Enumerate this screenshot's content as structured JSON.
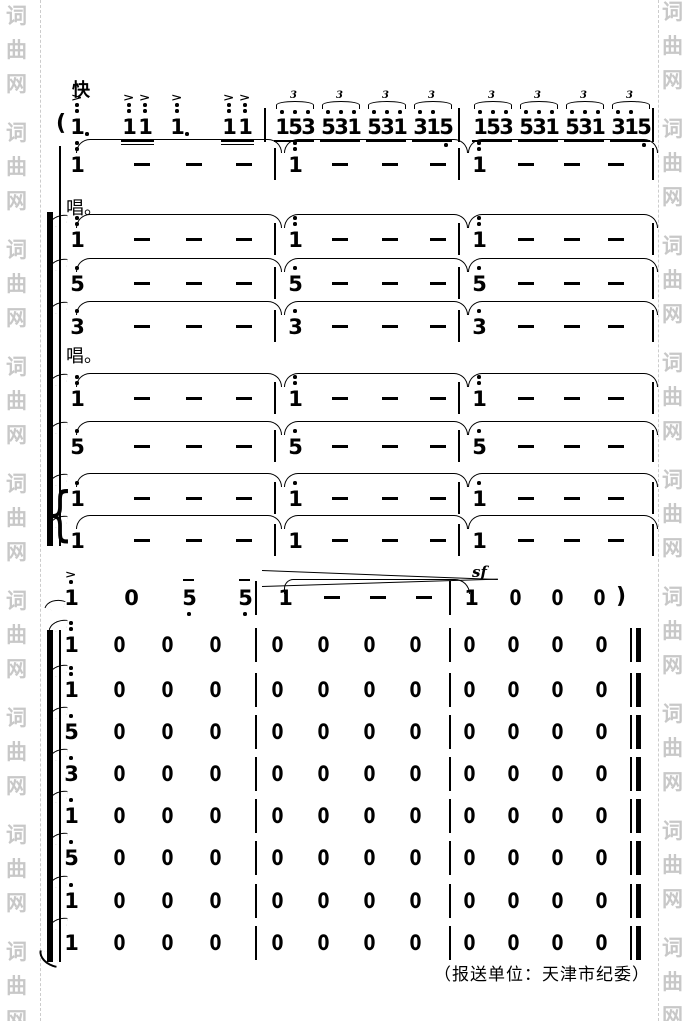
{
  "header": {
    "tempo": "快"
  },
  "labels": {
    "chang1": "唱。",
    "chang2": "唱。"
  },
  "credit": "（报送单位：天津市纪委）",
  "watermark": {
    "text": "词曲网",
    "color": "#c8c8c8",
    "repeats_per_side": 9
  },
  "lead_line": {
    "open_paren": "(",
    "tuplet_number": "3",
    "measure1": [
      {
        "type": "note",
        "digit": "1",
        "octave_dots": 2,
        "accent": true,
        "dotted": true
      },
      {
        "type": "pair",
        "digits": [
          "1",
          "1"
        ],
        "octave_dots": 2,
        "accent": true,
        "underlines": 2
      },
      {
        "type": "note",
        "digit": "1",
        "octave_dots": 2,
        "accent": true,
        "dotted": true
      },
      {
        "type": "pair",
        "digits": [
          "1",
          "1"
        ],
        "octave_dots": 2,
        "accent": true,
        "underlines": 2
      }
    ],
    "measure2_triplets": [
      [
        "1",
        "5",
        "3"
      ],
      [
        "5",
        "3",
        "1"
      ],
      [
        "5",
        "3",
        "1"
      ],
      [
        "3",
        "1",
        "5"
      ]
    ],
    "measure3_triplets": [
      [
        "1",
        "5",
        "3"
      ],
      [
        "5",
        "3",
        "1"
      ],
      [
        "5",
        "3",
        "1"
      ],
      [
        "3",
        "1",
        "5"
      ]
    ]
  },
  "held_rows": [
    {
      "start_digit": "1",
      "octave_dots": 2,
      "dashes": [
        "-",
        "-",
        "-"
      ]
    },
    {
      "start_digit": "1",
      "octave_dots": 2,
      "dashes": [
        "-",
        "-",
        "-"
      ]
    },
    {
      "start_digit": "5",
      "octave_dots": 1,
      "dashes": [
        "-",
        "-",
        "-"
      ]
    },
    {
      "start_digit": "3",
      "octave_dots": 1,
      "dashes": [
        "-",
        "-",
        "-"
      ]
    },
    {
      "start_digit": "1",
      "octave_dots": 2,
      "dashes": [
        "-",
        "-",
        "-"
      ]
    },
    {
      "start_digit": "5",
      "octave_dots": 1,
      "dashes": [
        "-",
        "-",
        "-"
      ]
    },
    {
      "start_digit": "1",
      "octave_dots": 1,
      "dashes": [
        "-",
        "-",
        "-"
      ]
    },
    {
      "start_digit": "1",
      "octave_dots": 0,
      "dashes": [
        "-",
        "-",
        "-"
      ]
    }
  ],
  "interlude_row": {
    "measure1": [
      {
        "digit": "1",
        "accent": true,
        "octave_dots": 1
      },
      {
        "digit": "0"
      },
      {
        "digit": "5",
        "tenuto": true,
        "low_dots": 1
      },
      {
        "digit": "5",
        "tenuto": true,
        "low_dots": 1
      }
    ],
    "measure2": [
      "1",
      "-",
      "-",
      "-"
    ],
    "measure3": [
      "1",
      "0",
      "0",
      "0"
    ],
    "sforzando": "sf",
    "close_paren": ")"
  },
  "rest_rows": [
    {
      "start_digit": "1",
      "octave_dots": 2,
      "rests_m1": [
        "0",
        "0",
        "0"
      ],
      "rests_m2": [
        "0",
        "0",
        "0",
        "0"
      ],
      "rests_m3": [
        "0",
        "0",
        "0",
        "0"
      ]
    },
    {
      "start_digit": "1",
      "octave_dots": 2,
      "rests_m1": [
        "0",
        "0",
        "0"
      ],
      "rests_m2": [
        "0",
        "0",
        "0",
        "0"
      ],
      "rests_m3": [
        "0",
        "0",
        "0",
        "0"
      ]
    },
    {
      "start_digit": "5",
      "octave_dots": 1,
      "rests_m1": [
        "0",
        "0",
        "0"
      ],
      "rests_m2": [
        "0",
        "0",
        "0",
        "0"
      ],
      "rests_m3": [
        "0",
        "0",
        "0",
        "0"
      ]
    },
    {
      "start_digit": "3",
      "octave_dots": 1,
      "rests_m1": [
        "0",
        "0",
        "0"
      ],
      "rests_m2": [
        "0",
        "0",
        "0",
        "0"
      ],
      "rests_m3": [
        "0",
        "0",
        "0",
        "0"
      ]
    },
    {
      "start_digit": "1",
      "octave_dots": 1,
      "rests_m1": [
        "0",
        "0",
        "0"
      ],
      "rests_m2": [
        "0",
        "0",
        "0",
        "0"
      ],
      "rests_m3": [
        "0",
        "0",
        "0",
        "0"
      ]
    },
    {
      "start_digit": "5",
      "octave_dots": 1,
      "rests_m1": [
        "0",
        "0",
        "0"
      ],
      "rests_m2": [
        "0",
        "0",
        "0",
        "0"
      ],
      "rests_m3": [
        "0",
        "0",
        "0",
        "0"
      ]
    },
    {
      "start_digit": "1",
      "octave_dots": 1,
      "rests_m1": [
        "0",
        "0",
        "0"
      ],
      "rests_m2": [
        "0",
        "0",
        "0",
        "0"
      ],
      "rests_m3": [
        "0",
        "0",
        "0",
        "0"
      ]
    },
    {
      "start_digit": "1",
      "octave_dots": 0,
      "rests_m1": [
        "0",
        "0",
        "0"
      ],
      "rests_m2": [
        "0",
        "0",
        "0",
        "0"
      ],
      "rests_m3": [
        "0",
        "0",
        "0",
        "0"
      ]
    }
  ]
}
